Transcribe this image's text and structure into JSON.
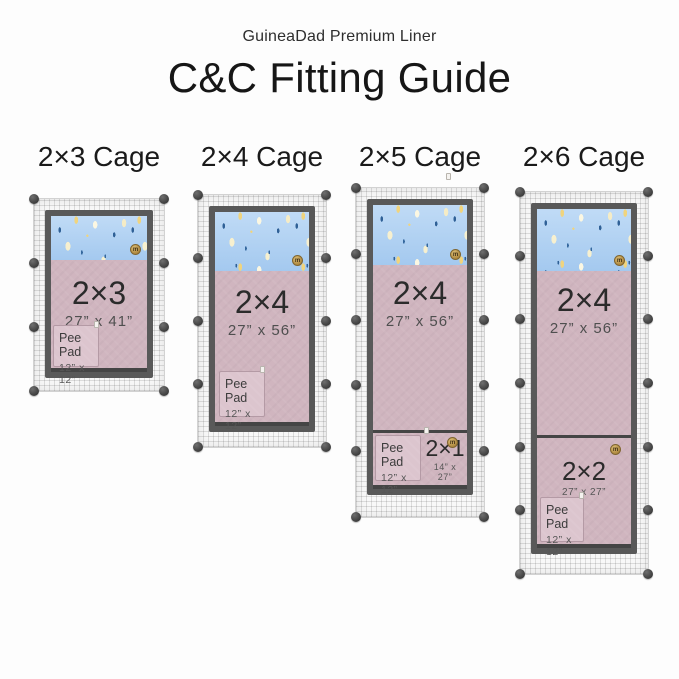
{
  "header": {
    "brand_line": "GuineaDad Premium Liner",
    "title": "C&C Fitting Guide"
  },
  "badge_glyph": "m",
  "cages": [
    {
      "heading": "2×3 Cage",
      "panels_tall": 3,
      "liners": [
        {
          "label": "2×3",
          "dims": "27” x 41”"
        }
      ],
      "pee_pad": {
        "label": "Pee Pad",
        "dims": "12” x 12”"
      }
    },
    {
      "heading": "2×4 Cage",
      "panels_tall": 4,
      "liners": [
        {
          "label": "2×4",
          "dims": "27” x 56”"
        }
      ],
      "pee_pad": {
        "label": "Pee Pad",
        "dims": "12” x 12”"
      }
    },
    {
      "heading": "2×5 Cage",
      "panels_tall": 5,
      "liners": [
        {
          "label": "2×4",
          "dims": "27” x 56”"
        },
        {
          "label": "2×1",
          "dims": "14” x 27”"
        }
      ],
      "pee_pad": {
        "label": "Pee Pad",
        "dims": "12” x 12”"
      }
    },
    {
      "heading": "2×6 Cage",
      "panels_tall": 6,
      "liners": [
        {
          "label": "2×4",
          "dims": "27” x 56”"
        },
        {
          "label": "2×2",
          "dims": "27” x 27”"
        }
      ],
      "pee_pad": {
        "label": "Pee Pad",
        "dims": "12” x 12”"
      }
    }
  ],
  "colors": {
    "fleece_top_blue": "#a9cdf0",
    "liner_pink": "#d0b5bf",
    "pee_pad_pink": "#dcc5ce",
    "frame_gray": "#595959",
    "connector_ball": "#454545",
    "logo_gold": "#c09a52",
    "pattern_navy": "#2f6096",
    "pattern_cream": "#f6efcd",
    "pattern_yellow": "#f0d47e"
  }
}
